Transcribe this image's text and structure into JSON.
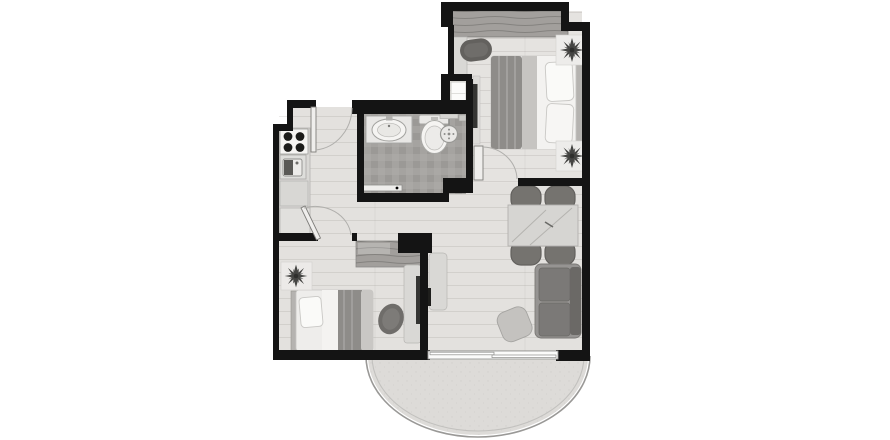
{
  "canvas": {
    "width": 890,
    "height": 440,
    "background": "#ffffff"
  },
  "palette": {
    "bg": "#ffffff",
    "wall": "#141414",
    "floor_main": "#e3e1de",
    "floor_bedroom": "#e5e3e0",
    "floor_bath": "#a8a6a3",
    "floor_balcony": "#dddbd8",
    "fixture_white": "#f5f4f2",
    "furn_light": "#d9d8d5",
    "furn_mid": "#a6a4a1",
    "furn_dark": "#6f6d6a",
    "blanket": "#8e8c89",
    "wood": "#a29f9c",
    "plant": "#454543",
    "line": "#9a9997",
    "door_leaf": "#efeeec"
  },
  "plan": {
    "kind": "apartment-floor-plan",
    "rooms": [
      {
        "id": "bedroom-main",
        "furniture": [
          "wardrobe",
          "desk-shelf",
          "bench",
          "double-bed",
          "pillow",
          "pillow",
          "plant",
          "plant",
          "wall-tv",
          "closet"
        ]
      },
      {
        "id": "bathroom",
        "furniture": [
          "vanity-sink",
          "toilet",
          "shower-head",
          "sliding-door"
        ]
      },
      {
        "id": "kitchen",
        "furniture": [
          "stove-4-burners",
          "kitchen-sink",
          "counter",
          "cabinet"
        ]
      },
      {
        "id": "bedroom-second",
        "furniture": [
          "single-bed",
          "pillow",
          "plant",
          "wardrobe-l",
          "desk",
          "tv",
          "office-chair"
        ]
      },
      {
        "id": "living-dining",
        "furniture": [
          "dining-table",
          "chair",
          "chair",
          "chair",
          "chair",
          "sofa-2-seat",
          "pouf",
          "tv-console"
        ]
      },
      {
        "id": "balcony",
        "furniture": [
          "curved-glass-railing",
          "sliding-door"
        ]
      }
    ],
    "doors": [
      "entry-door",
      "bedroom-main-door",
      "bedroom-second-door",
      "bathroom-sliding-door",
      "balcony-sliding-door"
    ]
  }
}
